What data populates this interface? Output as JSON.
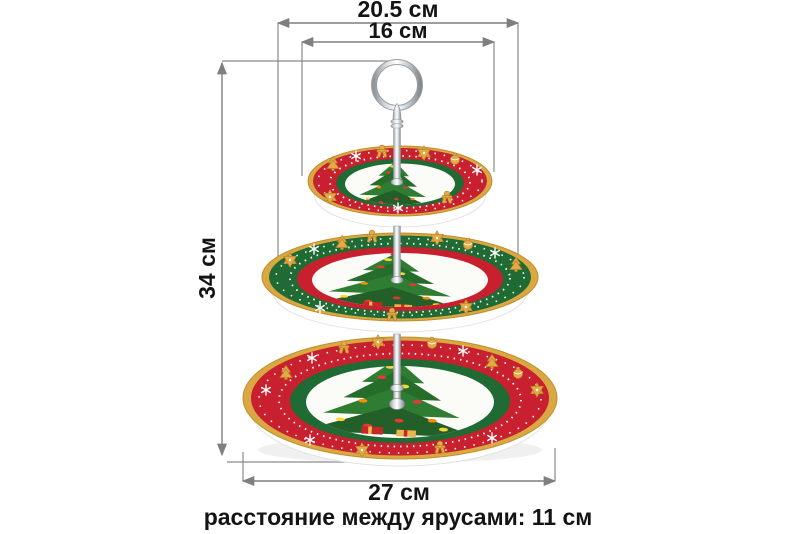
{
  "annotations": {
    "width_middle_tier": {
      "text": "20.5 см",
      "value": 20.5,
      "unit": "см"
    },
    "width_top_tier": {
      "text": "16 см",
      "value": 16,
      "unit": "см"
    },
    "height_total": {
      "text": "34 см",
      "value": 34,
      "unit": "см"
    },
    "width_bottom_tier": {
      "text": "27 см",
      "value": 27,
      "unit": "см"
    },
    "tier_spacing": {
      "text": "расстояние между ярусами: 11 см",
      "value": 11,
      "unit": "см"
    }
  },
  "colors": {
    "dimension_line": "#7f7f7f",
    "label_text": "#141414",
    "plate_red": "#c8202e",
    "plate_green": "#1f6b33",
    "plate_gold": "#d9a843",
    "tree_green": "#2e7d33",
    "chrome": "#c2c7cb",
    "background": "#ffffff"
  },
  "icons": {
    "band_decorations": [
      "star-icon",
      "gingerbread-icon",
      "snowflake-icon",
      "tree-cookie-icon",
      "ornament-icon"
    ]
  }
}
